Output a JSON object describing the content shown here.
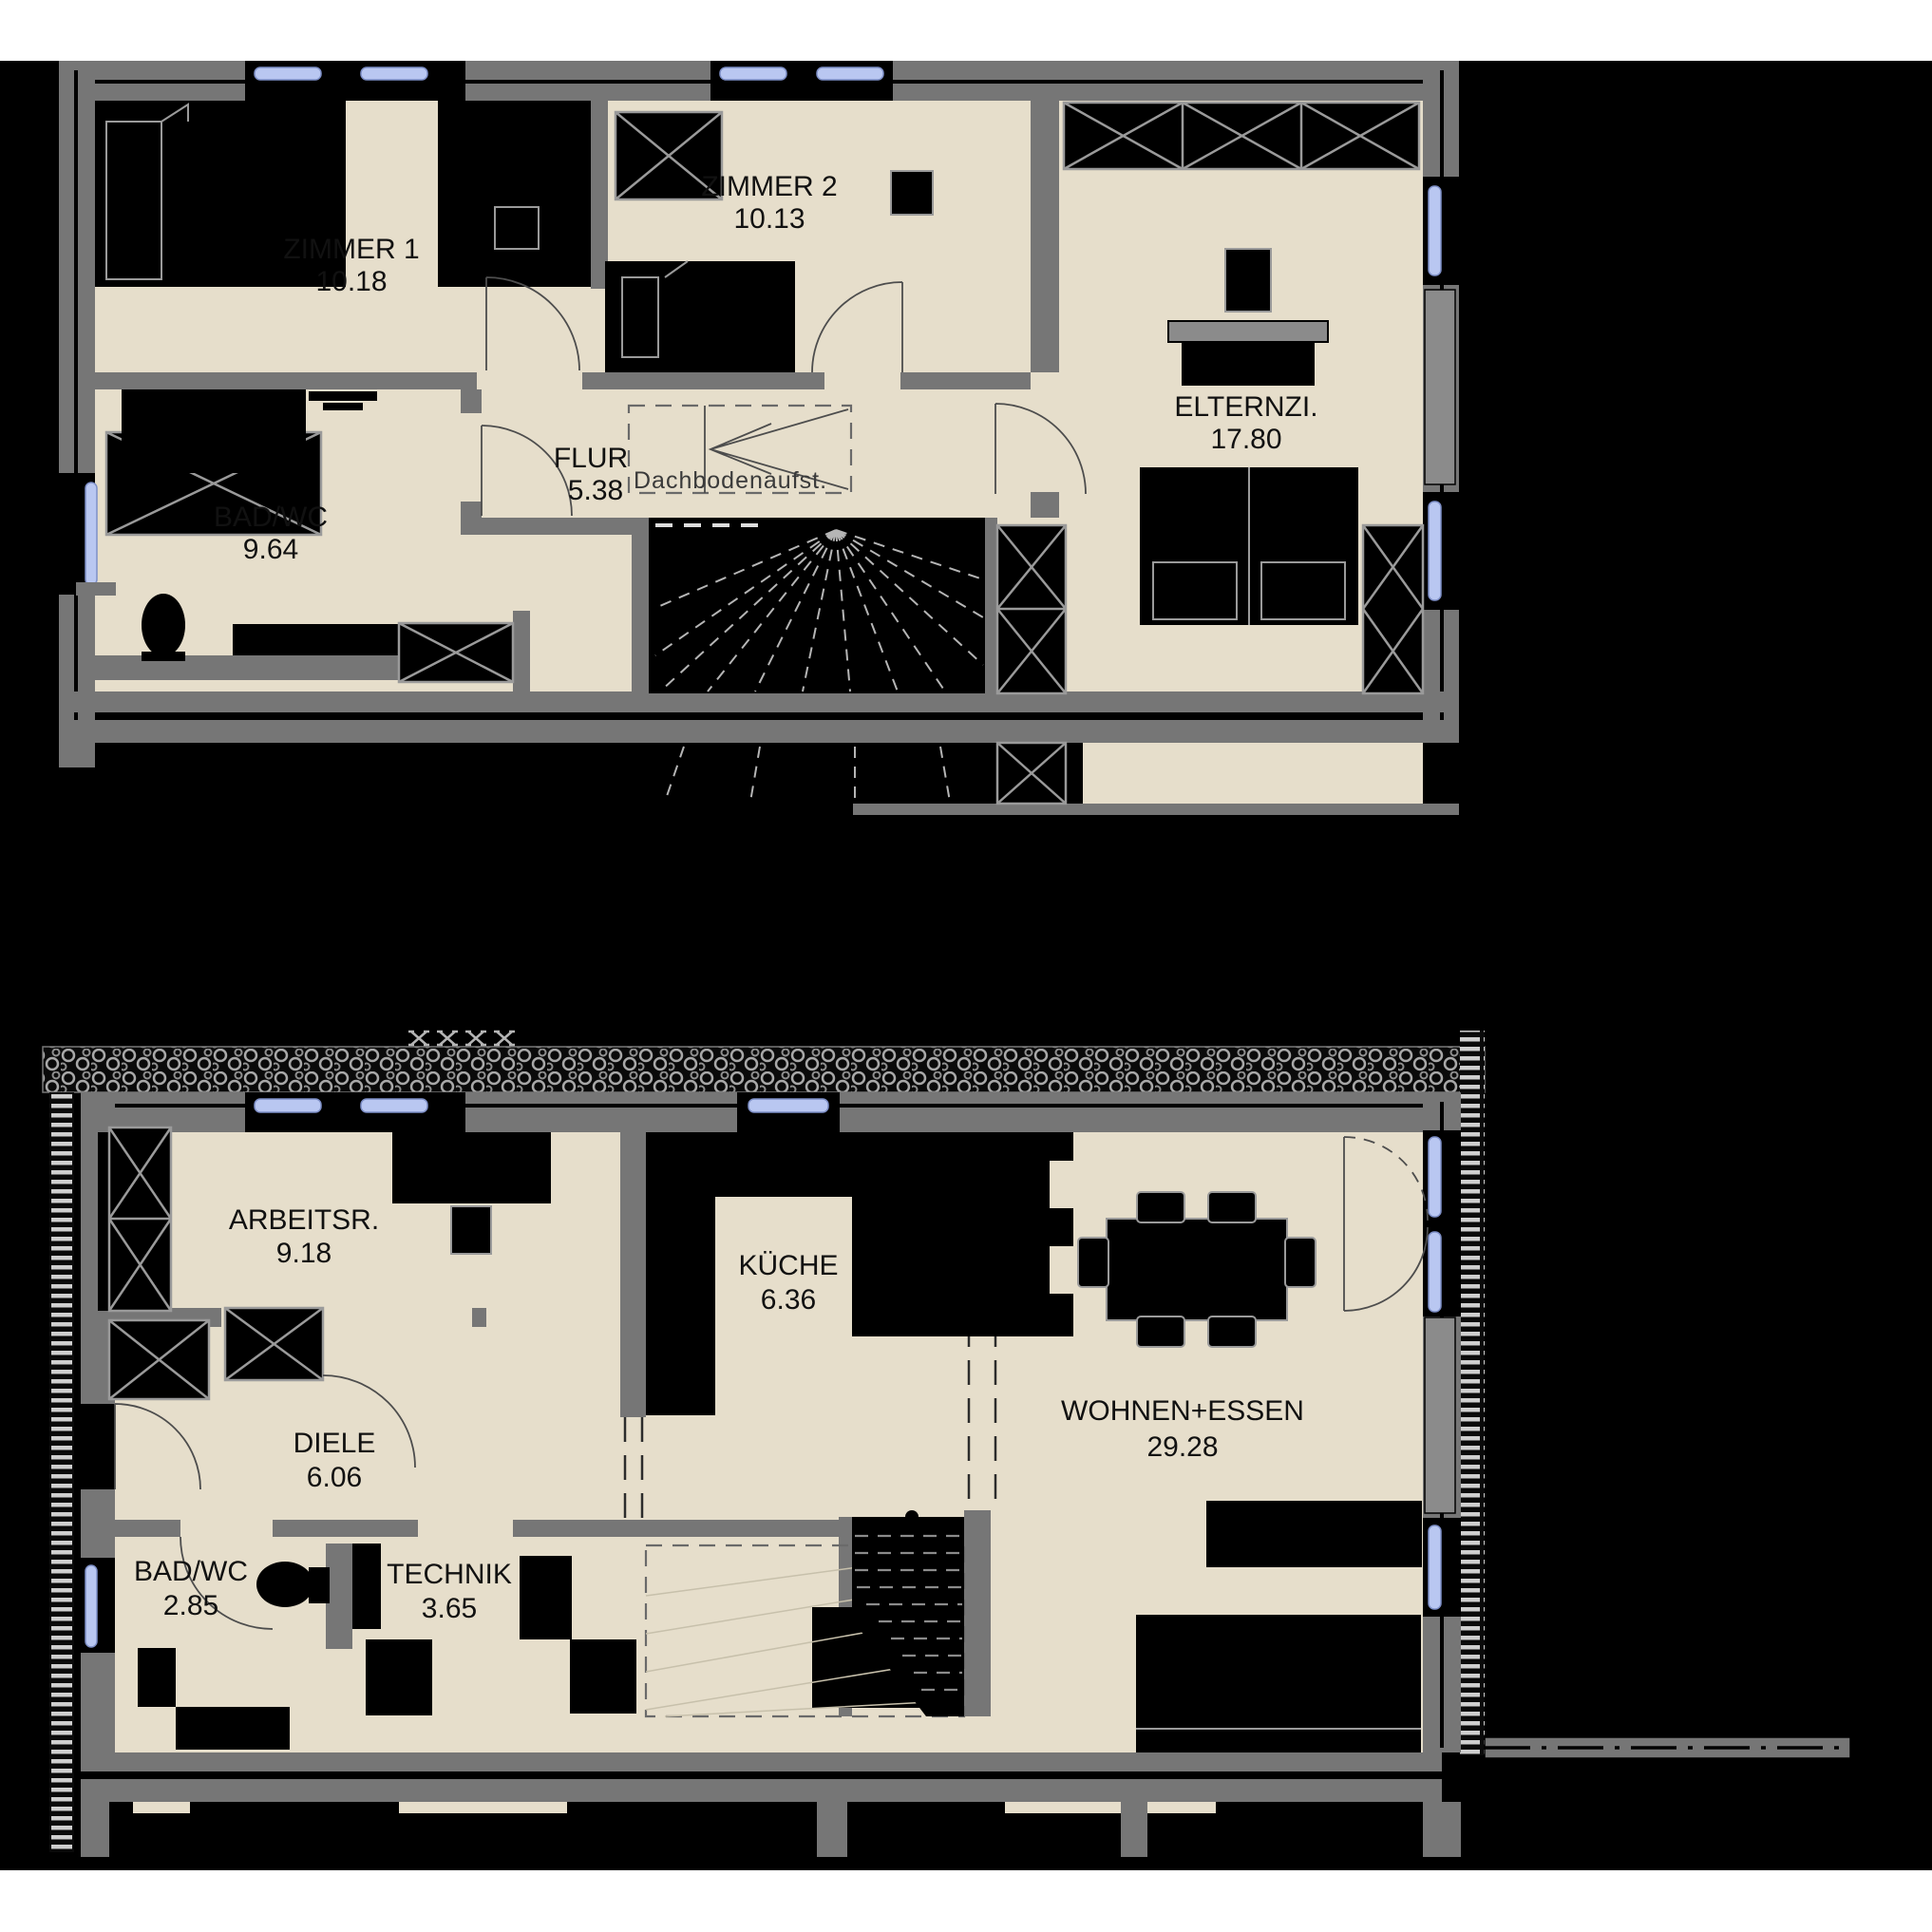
{
  "document": {
    "type": "floor-plan-drawing",
    "floors": 2
  },
  "upper_floor": {
    "name": "Obergeschoss plan",
    "rooms": [
      {
        "id": "zimmer1",
        "label": "ZIMMER 1",
        "area": "10.18"
      },
      {
        "id": "zimmer2",
        "label": "ZIMMER 2",
        "area": "10.13"
      },
      {
        "id": "elternzi",
        "label": "ELTERNZI.",
        "area": "17.80"
      },
      {
        "id": "flur",
        "label": "FLUR",
        "area": "5.38"
      },
      {
        "id": "badwc",
        "label": "BAD/WC",
        "area": "9.64"
      }
    ],
    "annotations": [
      {
        "id": "dachboden",
        "label": "Dachbodenaufst."
      }
    ]
  },
  "lower_floor": {
    "name": "Erdgeschoss plan",
    "rooms": [
      {
        "id": "arbeitsr",
        "label": "ARBEITSR.",
        "area": "9.18"
      },
      {
        "id": "kueche",
        "label": "KÜCHE",
        "area": "6.36"
      },
      {
        "id": "wohnen",
        "label": "WOHNEN+ESSEN",
        "area": "29.28"
      },
      {
        "id": "diele",
        "label": "DIELE",
        "area": "6.06"
      },
      {
        "id": "badwc",
        "label": "BAD/WC",
        "area": "2.85"
      },
      {
        "id": "technik",
        "label": "TECHNIK",
        "area": "3.65"
      }
    ]
  },
  "colors": {
    "background": "#000000",
    "paper": "#ffffff",
    "floor": "#e6decb",
    "wall": "#767676",
    "wall_light": "#8b8b8b",
    "window": "#b9c7f1",
    "window_frame": "#7e8fc7",
    "furniture": "#000000",
    "outline": "#9a9a9a",
    "label_text": "#111111",
    "annotation_text": "#3a3a3a"
  }
}
